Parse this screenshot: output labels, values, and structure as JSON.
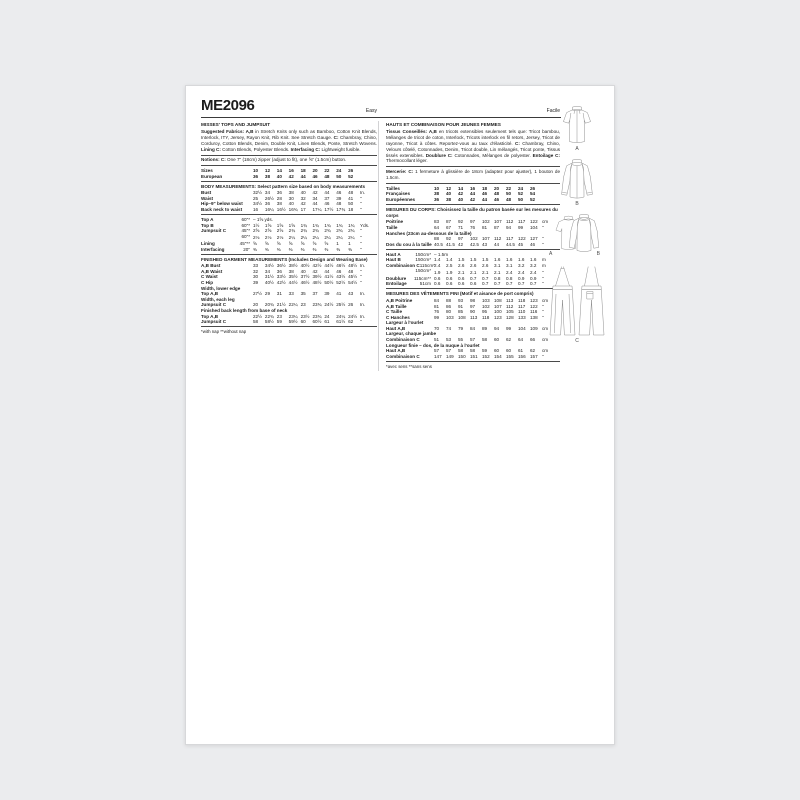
{
  "colors": {
    "canvas_bg": "#ebecee",
    "page_bg": "#ffffff",
    "text": "#1c1c1c",
    "rule": "#4a4a4a",
    "figure_stroke": "#8f8f8f"
  },
  "header": {
    "code": "ME2096",
    "difficulty_en": "Easy",
    "difficulty_fr": "Facile"
  },
  "en": {
    "title": "MISSES' TOPS AND JUMPSUIT",
    "fabrics_parts": [
      {
        "t": "Suggested Fabrics: A,B",
        "b": 1
      },
      {
        "t": " in Stretch Knits only such as Bamboo, Cotton Knit Blends, Interlock, ITY, Jersey, Rayon Knit, Rib Knit. See Stretch Gauge. "
      },
      {
        "t": "C:",
        "b": 1
      },
      {
        "t": " Chambray, Chino, Corduroy, Cotton Blends, Denim, Double Knit, Linen Blends, Ponte, Stretch Wovens. "
      },
      {
        "t": "Lining C:",
        "b": 1
      },
      {
        "t": " Cotton Blends, Polyester Blends. "
      },
      {
        "t": "Interfacing C:",
        "b": 1
      },
      {
        "t": " Lightweight fusible."
      }
    ],
    "notions_parts": [
      {
        "t": "Notions: C:",
        "b": 1
      },
      {
        "t": " One 7\" (18cm) zipper (adjust to fit), one ⅝\" (1.5cm) button."
      }
    ],
    "size_rows": [
      {
        "label": "Sizes",
        "values": [
          "10",
          "12",
          "14",
          "16",
          "18",
          "20",
          "22",
          "24",
          "26"
        ],
        "unit": "",
        "bold": 1
      },
      {
        "label": "European",
        "values": [
          "36",
          "38",
          "40",
          "42",
          "44",
          "46",
          "48",
          "50",
          "52"
        ],
        "unit": "",
        "bold": 1
      }
    ],
    "body_heading": "BODY MEASUREMENTS: Select pattern size based on body measurements",
    "body_rows": [
      {
        "label": "Bust",
        "values": [
          "32½",
          "34",
          "36",
          "38",
          "40",
          "42",
          "44",
          "46",
          "48"
        ],
        "unit": "In."
      },
      {
        "label": "Waist",
        "values": [
          "25",
          "26½",
          "28",
          "30",
          "32",
          "34",
          "37",
          "39",
          "41"
        ],
        "unit": "\""
      },
      {
        "label": "Hip–9\" below waist",
        "values": [
          "34½",
          "36",
          "38",
          "40",
          "42",
          "44",
          "46",
          "48",
          "50"
        ],
        "unit": "\""
      },
      {
        "label": "Back neck to waist",
        "values": [
          "16",
          "16¼",
          "16½",
          "16¾",
          "17",
          "17¼",
          "17½",
          "17¾",
          "18"
        ],
        "unit": "\""
      }
    ],
    "yardage_rows": [
      {
        "label": "Top A",
        "sub": "60\"*",
        "span": "– 1⅝ yds."
      },
      {
        "label": "Top B",
        "sub": "60\"*",
        "values": [
          "1½",
          "1⅝",
          "1⅝",
          "1⅝",
          "1¾",
          "1¾",
          "1¾",
          "1¾",
          "1¾"
        ],
        "unit": "Yds."
      },
      {
        "label": "Jumpsuit C",
        "sub": "45\"*",
        "values": [
          "2⅝",
          "2⅝",
          "2⅝",
          "2¾",
          "2¾",
          "2¾",
          "2¾",
          "2¾",
          "2¾"
        ],
        "unit": "\""
      },
      {
        "label": "",
        "sub": "60\"*",
        "values": [
          "2⅛",
          "2⅛",
          "2⅛",
          "2¼",
          "2¼",
          "2¼",
          "2¼",
          "2¼",
          "2¼"
        ],
        "unit": "\""
      },
      {
        "label": "Lining",
        "sub": "45\"**",
        "values": [
          "⅝",
          "⅝",
          "⅝",
          "⅝",
          "⅝",
          "⅝",
          "⅝",
          "1",
          "1"
        ],
        "unit": "\""
      },
      {
        "label": "Interfacing",
        "sub": "20\"",
        "values": [
          "⅜",
          "⅜",
          "⅜",
          "⅜",
          "⅜",
          "⅜",
          "⅜",
          "⅜",
          "⅜"
        ],
        "unit": "\""
      }
    ],
    "finished_heading": "FINISHED GARMENT MEASUREMENTS (Includes Design and Wearing Ease)",
    "finished_rows": [
      {
        "label": "A,B Bust",
        "values": [
          "33",
          "34½",
          "36½",
          "38½",
          "40½",
          "42½",
          "44½",
          "46½",
          "48½"
        ],
        "unit": "In."
      },
      {
        "label": "A,B Waist",
        "values": [
          "32",
          "34",
          "36",
          "38",
          "40",
          "42",
          "44",
          "46",
          "48"
        ],
        "unit": "\""
      },
      {
        "label": "C Waist",
        "values": [
          "30",
          "31½",
          "33½",
          "35½",
          "37½",
          "39½",
          "41½",
          "43½",
          "45½"
        ],
        "unit": "\""
      },
      {
        "label": "C Hip",
        "values": [
          "39",
          "40½",
          "42½",
          "44½",
          "46½",
          "48½",
          "50½",
          "52½",
          "54½"
        ],
        "unit": "\""
      },
      {
        "label": "Width, lower edge",
        "label_only": 1
      },
      {
        "label": "Top A,B",
        "values": [
          "27½",
          "29",
          "31",
          "33",
          "35",
          "37",
          "39",
          "41",
          "43"
        ],
        "unit": "In."
      },
      {
        "label": "Width, each leg",
        "label_only": 1
      },
      {
        "label": "Jumpsuit C",
        "values": [
          "20",
          "20¾",
          "21½",
          "22¼",
          "23",
          "23¾",
          "24½",
          "25½",
          "26"
        ],
        "unit": "In."
      },
      {
        "label": "Finished back length from base of neck",
        "label_only": 1
      },
      {
        "label": "Top A,B",
        "values": [
          "22½",
          "22¾",
          "23",
          "23¼",
          "23½",
          "23¾",
          "24",
          "24¼",
          "24½"
        ],
        "unit": "In."
      },
      {
        "label": "Jumpsuit C",
        "values": [
          "58",
          "58½",
          "59",
          "59½",
          "60",
          "60½",
          "61",
          "61½",
          "62"
        ],
        "unit": "\""
      }
    ],
    "footnote": "*with nap    **without nap"
  },
  "fr": {
    "title": "HAUTS ET COMBINAISON POUR JEUNES FEMMES",
    "fabrics_parts": [
      {
        "t": "Tissus Conseillés: A,B",
        "b": 1
      },
      {
        "t": " en tricots extensibles seulement tels que: Tricot bambou, Mélanges de tricot de coton, Interlock, Tricots interlock en fil retors, Jersey, Tricot de rayonne, Tricot à côtes. Reportez-vous au taux d'élasticité. "
      },
      {
        "t": "C:",
        "b": 1
      },
      {
        "t": " Chambray, Chino, Velours côtelé, Cotonnades, Denim, Tricot double, Lin mélangés, Tricot ponte, Tissus tissés extensibles. "
      },
      {
        "t": "Doublure C:",
        "b": 1
      },
      {
        "t": " Cotonnades, Mélanges de polyester. "
      },
      {
        "t": "Entoilage C:",
        "b": 1
      },
      {
        "t": " Thermocollant léger."
      }
    ],
    "notions_parts": [
      {
        "t": "Mercerie: C:",
        "b": 1
      },
      {
        "t": " 1 fermeture à glissière de 18cm (adaptez pour ajuster), 1 bouton de 1.5cm."
      }
    ],
    "size_rows": [
      {
        "label": "Tailles",
        "values": [
          "10",
          "12",
          "14",
          "16",
          "18",
          "20",
          "22",
          "24",
          "26"
        ],
        "unit": "",
        "bold": 1
      },
      {
        "label": "Françaises",
        "values": [
          "38",
          "40",
          "42",
          "44",
          "46",
          "48",
          "50",
          "52",
          "54"
        ],
        "unit": "",
        "bold": 1
      },
      {
        "label": "Européennes",
        "values": [
          "36",
          "38",
          "40",
          "42",
          "44",
          "46",
          "48",
          "50",
          "52"
        ],
        "unit": "",
        "bold": 1
      }
    ],
    "body_heading": "MESURES DU CORPS: Choisissez la taille du patron basée sur les mesures du corps",
    "body_rows": [
      {
        "label": "Poitrine",
        "values": [
          "83",
          "87",
          "92",
          "97",
          "102",
          "107",
          "112",
          "117",
          "122"
        ],
        "unit": "cm"
      },
      {
        "label": "Taille",
        "values": [
          "64",
          "67",
          "71",
          "76",
          "81",
          "87",
          "94",
          "99",
          "104"
        ],
        "unit": "\""
      },
      {
        "label": "Hanches (23cm au-dessous de la taille)",
        "label_only": 1
      },
      {
        "label": "",
        "values": [
          "88",
          "92",
          "97",
          "102",
          "107",
          "112",
          "117",
          "122",
          "127"
        ],
        "unit": "\""
      },
      {
        "label": "Dos du cou à la taille",
        "values": [
          "40.5",
          "41.5",
          "42",
          "42.5",
          "43",
          "44",
          "44.5",
          "45",
          "46"
        ],
        "unit": "\""
      }
    ],
    "yardage_rows": [
      {
        "label": "Haut A",
        "sub": "150cm*",
        "span": "– 1.5m"
      },
      {
        "label": "Haut B",
        "sub": "150cm*",
        "values": [
          "1.4",
          "1.4",
          "1.5",
          "1.5",
          "1.5",
          "1.6",
          "1.6",
          "1.6",
          "1.6"
        ],
        "unit": "m"
      },
      {
        "label": "Combinaison C",
        "sub": "115cm*",
        "values": [
          "2.4",
          "2.5",
          "2.6",
          "2.6",
          "2.6",
          "3.1",
          "3.1",
          "3.2",
          "3.2"
        ],
        "unit": "m"
      },
      {
        "label": "",
        "sub": "150cm*",
        "values": [
          "1.9",
          "1.9",
          "2.1",
          "2.1",
          "2.1",
          "2.1",
          "2.4",
          "2.4",
          "2.4"
        ],
        "unit": "\""
      },
      {
        "label": "Doublure",
        "sub": "115cm**",
        "values": [
          "0.6",
          "0.6",
          "0.6",
          "0.7",
          "0.7",
          "0.8",
          "0.8",
          "0.9",
          "0.9"
        ],
        "unit": "\""
      },
      {
        "label": "Entoilage",
        "sub": "51cm",
        "values": [
          "0.6",
          "0.6",
          "0.6",
          "0.6",
          "0.7",
          "0.7",
          "0.7",
          "0.7",
          "0.7"
        ],
        "unit": "\""
      }
    ],
    "finished_heading": "MESURES DES VÊTEMENTS FINI (Motif et aisance de port compris)",
    "finished_rows": [
      {
        "label": "A,B Poitrine",
        "values": [
          "84",
          "88",
          "93",
          "98",
          "103",
          "108",
          "113",
          "118",
          "123"
        ],
        "unit": "cm"
      },
      {
        "label": "A,B Taille",
        "values": [
          "81",
          "86",
          "91",
          "97",
          "102",
          "107",
          "112",
          "117",
          "122"
        ],
        "unit": "\""
      },
      {
        "label": "C Taille",
        "values": [
          "76",
          "80",
          "85",
          "90",
          "95",
          "100",
          "105",
          "110",
          "116"
        ],
        "unit": "\""
      },
      {
        "label": "C Hanches",
        "values": [
          "99",
          "103",
          "108",
          "113",
          "118",
          "123",
          "128",
          "133",
          "138"
        ],
        "unit": "\""
      },
      {
        "label": "Largeur à l'ourlet",
        "label_only": 1
      },
      {
        "label": "Haut A,B",
        "values": [
          "70",
          "74",
          "79",
          "84",
          "89",
          "94",
          "99",
          "104",
          "109"
        ],
        "unit": "cm"
      },
      {
        "label": "Largeur, chaque jambe",
        "label_only": 1
      },
      {
        "label": "Combinaison C",
        "values": [
          "51",
          "53",
          "55",
          "57",
          "58",
          "60",
          "62",
          "64",
          "66"
        ],
        "unit": "cm"
      },
      {
        "label": "Longueur finie – dos, de la nuque à l'ourlet",
        "label_only": 1
      },
      {
        "label": "Haut A,B",
        "values": [
          "57",
          "57",
          "58",
          "58",
          "59",
          "60",
          "60",
          "61",
          "62"
        ],
        "unit": "cm"
      },
      {
        "label": "Combinaison C",
        "values": [
          "147",
          "149",
          "150",
          "151",
          "152",
          "154",
          "155",
          "156",
          "157"
        ],
        "unit": "\""
      }
    ],
    "footnote": "*avec sens    **sans sens"
  },
  "figures": {
    "top_a": "A",
    "top_b": "B",
    "front_a": "A",
    "front_b": "B",
    "jumpsuit_c": "C"
  }
}
